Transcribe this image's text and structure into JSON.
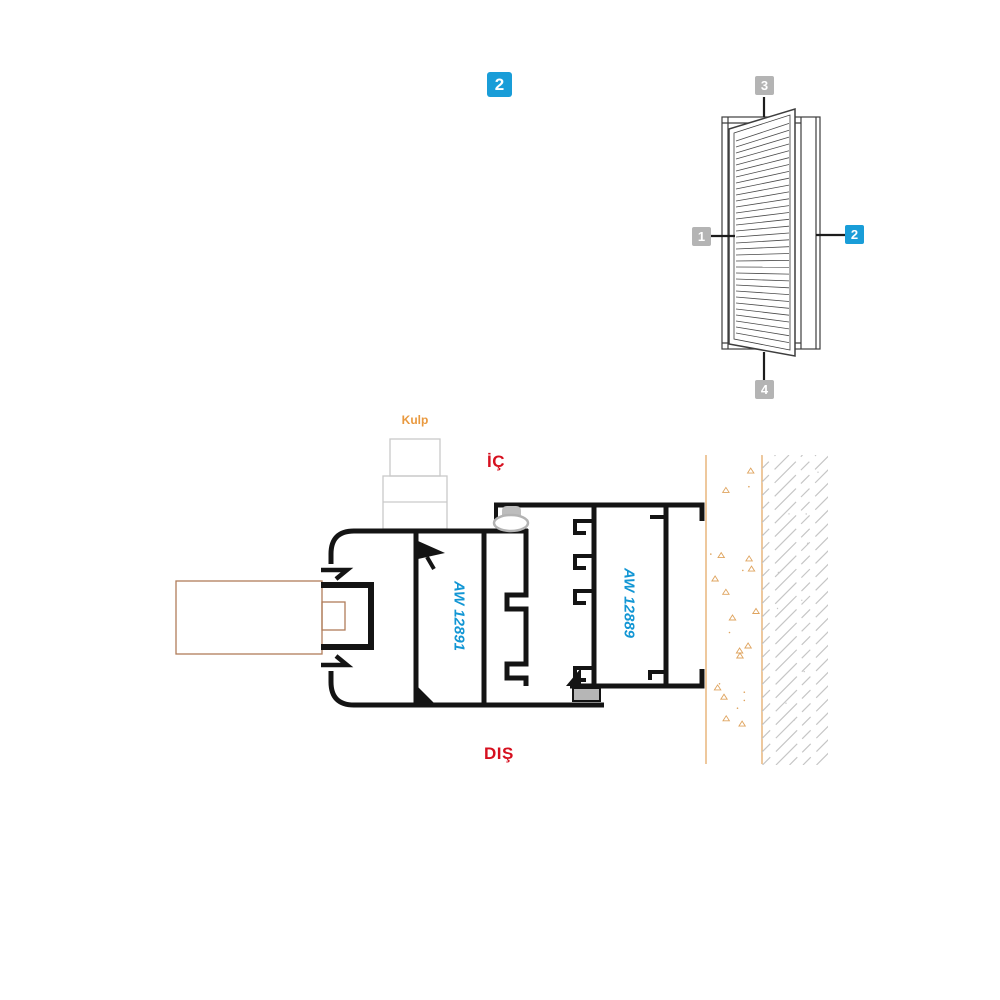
{
  "page": {
    "badge": "2"
  },
  "elevation": {
    "description": "louver-shutter-elevation",
    "callouts": [
      {
        "label": "1",
        "style": "gray"
      },
      {
        "label": "2",
        "style": "blue"
      },
      {
        "label": "3",
        "style": "gray"
      },
      {
        "label": "4",
        "style": "gray"
      }
    ]
  },
  "section": {
    "handle_label": "Kulp",
    "interior_label": "İÇ",
    "exterior_label": "DIŞ",
    "sash_profile_code": "AW 12891",
    "frame_profile_code": "AW 12889"
  },
  "colors": {
    "accent_blue": "#199dd8",
    "callout_gray": "#b4b4b4",
    "direction_red": "#d6101f",
    "handle_orange": "#e9993f",
    "wall_line_orange": "#e2a45c",
    "profile_code_blue": "#1296d4",
    "profile_black": "#141414"
  }
}
